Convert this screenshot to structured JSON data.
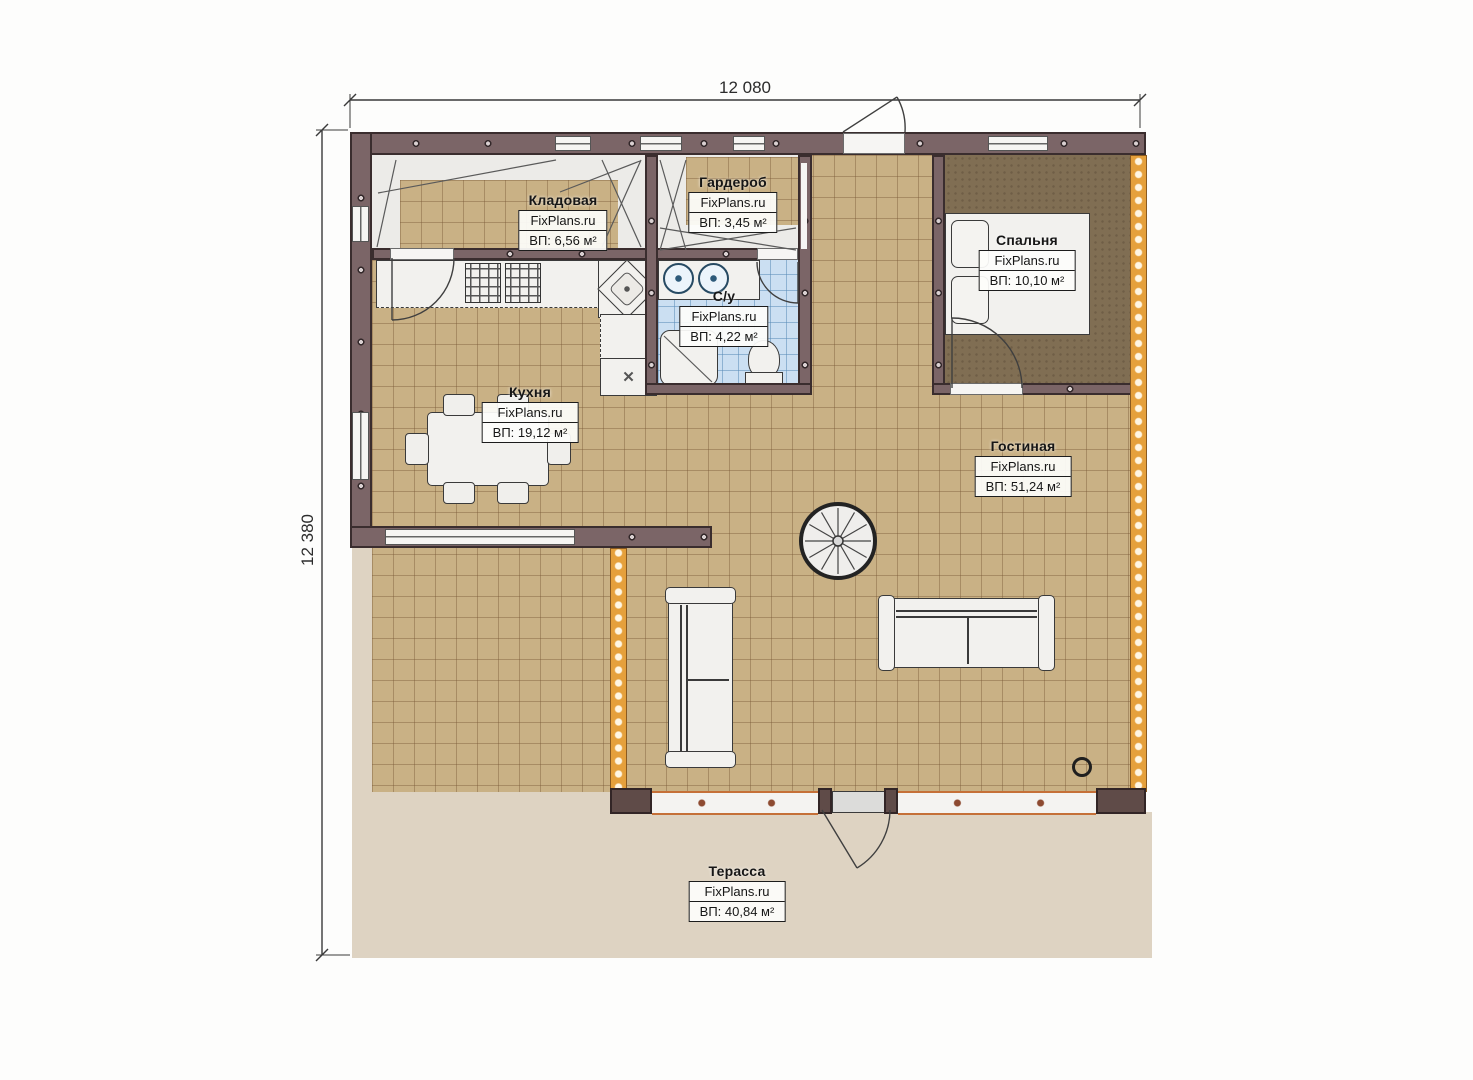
{
  "plan": {
    "type": "floor-plan",
    "brand": "FixPlans.ru",
    "dimensions": {
      "width": "12 080",
      "height": "12 380"
    },
    "rooms": [
      {
        "key": "kladovaya",
        "name": "Кладовая",
        "brand": "FixPlans.ru",
        "area": "ВП: 6,56 м²"
      },
      {
        "key": "garderob",
        "name": "Гардероб",
        "brand": "FixPlans.ru",
        "area": "ВП: 3,45 м²"
      },
      {
        "key": "su",
        "name": "С/у",
        "brand": "FixPlans.ru",
        "area": "ВП: 4,22 м²"
      },
      {
        "key": "spalnya",
        "name": "Спальня",
        "brand": "FixPlans.ru",
        "area": "ВП: 10,10 м²"
      },
      {
        "key": "kuhnya",
        "name": "Кухня",
        "brand": "FixPlans.ru",
        "area": "ВП: 19,12 м²"
      },
      {
        "key": "gostinaya",
        "name": "Гостиная",
        "brand": "FixPlans.ru",
        "area": "ВП: 51,24 м²"
      },
      {
        "key": "terassa",
        "name": "Терасса",
        "brand": "FixPlans.ru",
        "area": "ВП: 40,84 м²"
      }
    ],
    "colors": {
      "wall": "#7b6567",
      "floor_tile": "#c9b185",
      "bedroom_floor": "#806e53",
      "bathroom_tile": "#cbdff2",
      "terrace": "#ded3c2",
      "insulation": "#e5a03c",
      "window_accent": "#c57038"
    }
  }
}
